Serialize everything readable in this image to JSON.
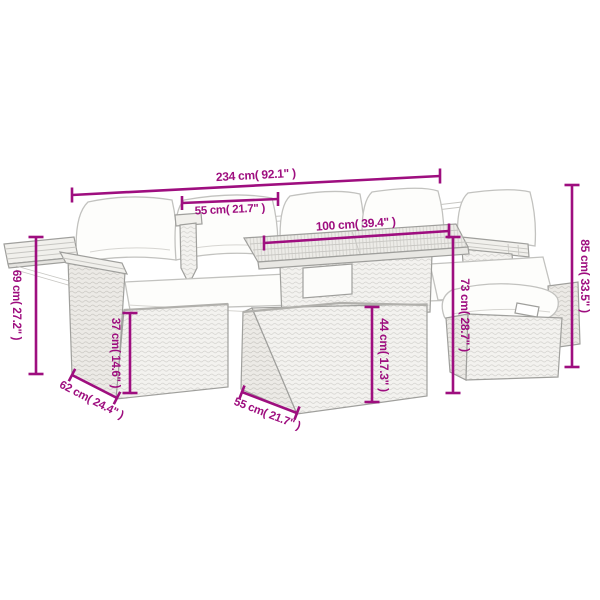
{
  "diagram": {
    "type": "furniture-dimension-diagram",
    "colors": {
      "dimension": "#9e0e7f",
      "line_art": "#9f9f9c",
      "cushion": "#fdfdfb",
      "background": "#ffffff"
    },
    "dimensions": [
      {
        "id": "overall-width",
        "cm": 234,
        "inches": 92.1,
        "label": "234 cm( 92.1\" )"
      },
      {
        "id": "seat-width",
        "cm": 55,
        "inches": 21.7,
        "label": "55 cm( 21.7\" )"
      },
      {
        "id": "tabletop-length",
        "cm": 100,
        "inches": 39.4,
        "label": "100 cm( 39.4\" )"
      },
      {
        "id": "overall-height",
        "cm": 85,
        "inches": 33.5,
        "label": "85 cm( 33.5\" )"
      },
      {
        "id": "armrest-height",
        "cm": 69,
        "inches": 27.2,
        "label": "69 cm( 27.2\" )"
      },
      {
        "id": "seat-height",
        "cm": 37,
        "inches": 14.6,
        "label": "37 cm( 14.6\" )"
      },
      {
        "id": "table-height",
        "cm": 73,
        "inches": 28.7,
        "label": "73 cm( 28.7\" )"
      },
      {
        "id": "table-base-height",
        "cm": 44,
        "inches": 17.3,
        "label": "44 cm( 17.3\" )"
      },
      {
        "id": "seat-depth",
        "cm": 62,
        "inches": 24.4,
        "label": "62 cm( 24.4\" )"
      },
      {
        "id": "table-base-depth",
        "cm": 55,
        "inches": 21.7,
        "label": "55 cm( 21.7\" )"
      }
    ]
  }
}
